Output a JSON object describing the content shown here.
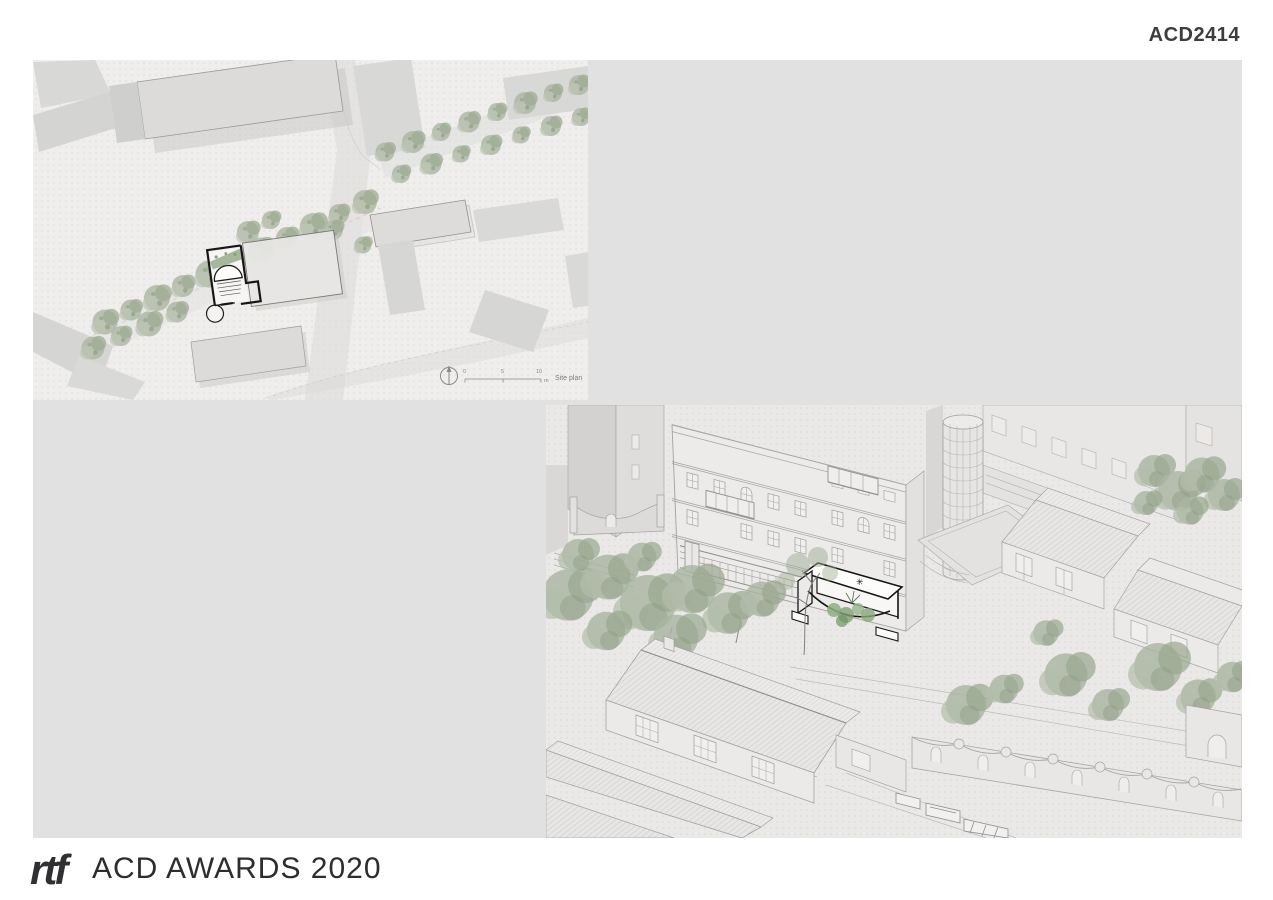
{
  "header": {
    "code": "ACD2414"
  },
  "site_plan": {
    "label": "Site plan",
    "scale_ticks": [
      "0",
      "5",
      "10"
    ],
    "scale_unit": "m"
  },
  "axon": {
    "canopy_mark": "✳"
  },
  "footer": {
    "logo_text": "rtf",
    "title": "ACD AWARDS 2020"
  },
  "colors": {
    "page_bg": "#ffffff",
    "canvas_gray": "#e1e1e1",
    "site_paper": "#efeeec",
    "axon_paper": "#eae9e7",
    "drawing_line": "#a8a7a5",
    "building_mass": "#d8d8d6",
    "tree_green": "#a9b4a1",
    "plan_green": "#9cb191",
    "highlight_ink": "#161616",
    "text_ink": "#3d3d3d"
  }
}
